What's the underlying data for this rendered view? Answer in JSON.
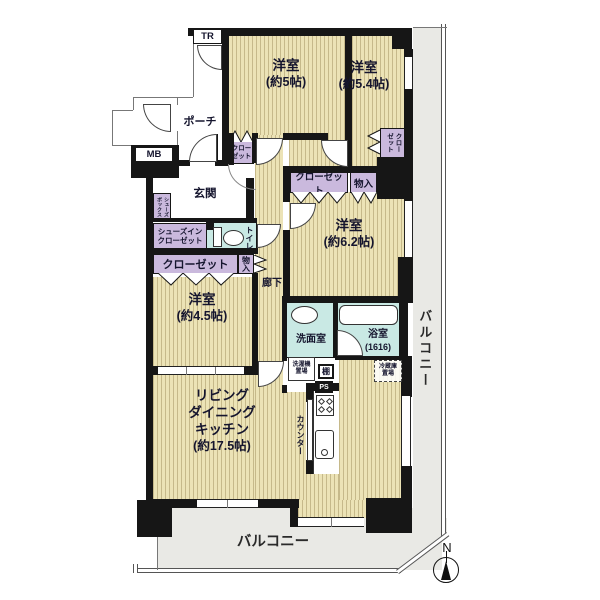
{
  "plan": {
    "tr": "TR",
    "mb": "MB",
    "porch": "ポーチ",
    "genkan": "玄関",
    "corridor": "廊下",
    "room5_name": "洋室",
    "room5_size": "(約5帖)",
    "room54_name": "洋室",
    "room54_size": "(約5.4帖)",
    "room62_name": "洋室",
    "room62_size": "(約6.2帖)",
    "room45_name": "洋室",
    "room45_size": "(約4.5帖)",
    "ldk_l1": "リビング",
    "ldk_l2": "ダイニング",
    "ldk_l3": "キッチン",
    "ldk_size": "(約17.5帖)",
    "closet5_l1": "クロー",
    "closet5_l2": "ゼット",
    "closet54_l1": "クロー",
    "closet54_l2": "ゼット",
    "closet_mid": "クローゼット",
    "monoiri_mid": "物入",
    "shoes_in_l1": "シューズイン",
    "shoes_in_l2": "クローゼット",
    "shoes_box_l1": "シューズ",
    "shoes_box_l2": "ボックス",
    "closet45": "クローゼット",
    "monoiri45": "物入",
    "toilet": "トイレ",
    "wash": "洗面室",
    "laundry_l1": "洗濯機",
    "laundry_l2": "置場",
    "shelf": "棚",
    "ps": "PS",
    "bath": "浴室",
    "bath_size": "(1616)",
    "fridge_l1": "冷蔵庫",
    "fridge_l2": "置場",
    "counter": "カウンター",
    "balcony_right": "バルコニー",
    "balcony_bottom": "バルコニー",
    "north": "N"
  },
  "colors": {
    "wall": "#161616",
    "floor": "#ece3b6",
    "floor_stripe": "#c6b98a",
    "storage": "#cab9dd",
    "wet": "#c9e9e4",
    "balcony": "#e9e9e5"
  }
}
